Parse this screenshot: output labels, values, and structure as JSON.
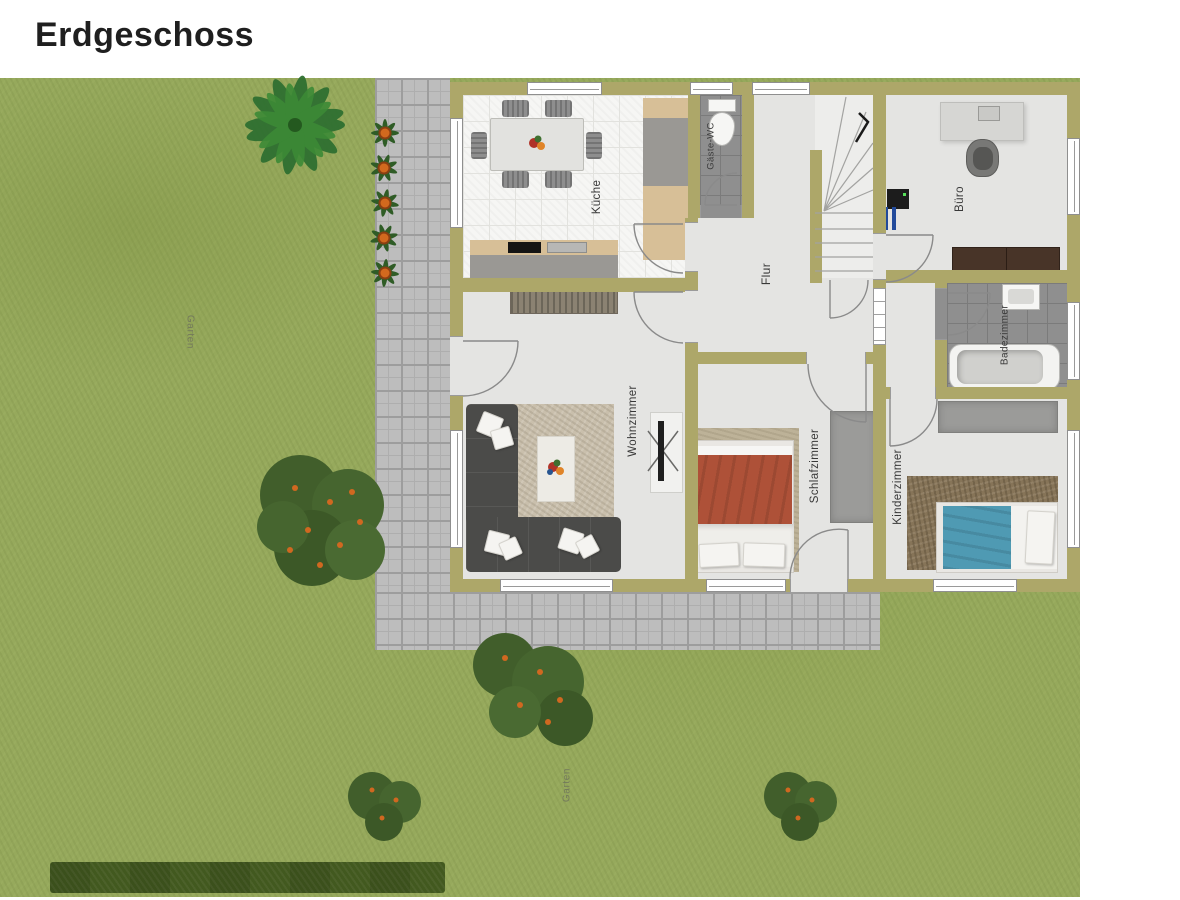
{
  "header": {
    "title": "Erdgeschoss"
  },
  "floor_plan": {
    "rooms": {
      "kueche": {
        "label": "Küche"
      },
      "gaeste_wc": {
        "label": "Gäste-WC"
      },
      "flur": {
        "label": "Flur"
      },
      "buero": {
        "label": "Büro"
      },
      "badezimmer": {
        "label": "Badezimmer"
      },
      "wohnzimmer": {
        "label": "Wohnzimmer"
      },
      "schlafzimmer": {
        "label": "Schlafzimmer"
      },
      "kinderzimmer": {
        "label": "Kinderzimmer"
      }
    },
    "garden": {
      "label_left": "Garten",
      "label_bottom": "Garten"
    },
    "colors": {
      "wall": "#ada769",
      "grass": "#96a95c",
      "pavement": "#bdbdbd",
      "room_floor": "#e4e4e2",
      "dark_tile": "#8f8f8f",
      "hedge": "#42591f",
      "sofa": "#4b4b49",
      "double_bed_duvet": "#ae5138",
      "single_bed_duvet": "#4f9ab3",
      "office_sideboard": "#483428"
    }
  }
}
